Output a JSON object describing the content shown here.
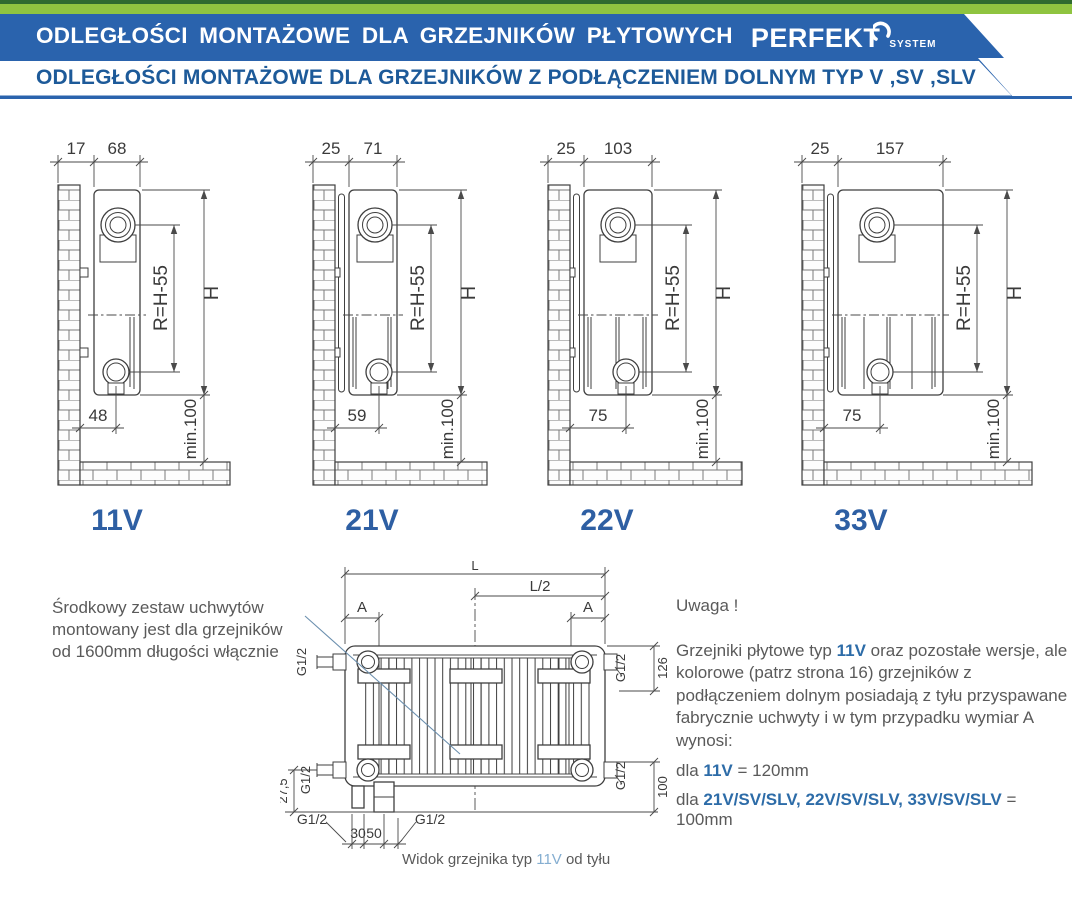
{
  "header": {
    "title": "ODLEGŁOŚCI MONTAŻOWE DLA GRZEJNIKÓW PŁYTOWYCH",
    "brand": "PERFEKT",
    "brand_sub": "SYSTEM",
    "subtitle": "ODLEGŁOŚCI MONTAŻOWE DLA GRZEJNIKÓW Z PODŁĄCZENIEM DOLNYM TYP V ,SV ,SLV"
  },
  "colors": {
    "green_strip": "#8fc440",
    "green_dark": "#2f6b2f",
    "banner_blue": "#2a63ad",
    "subtitle_blue": "#1d5a99",
    "type_label_blue": "#2e5fa3",
    "accent_blue": "#2d6ca8",
    "caption_blue": "#85aed1",
    "text_gray": "#5a5a5a",
    "drawing_line": "#3f3f3f"
  },
  "shared_dims": {
    "r": "R=H-55",
    "h": "H",
    "min": "min.100"
  },
  "diagrams": [
    {
      "label": "11V",
      "wall_offset": "17",
      "depth": "68",
      "pipe_offset": "48"
    },
    {
      "label": "21V",
      "wall_offset": "25",
      "depth": "71",
      "pipe_offset": "59"
    },
    {
      "label": "22V",
      "wall_offset": "25",
      "depth": "103",
      "pipe_offset": "75"
    },
    {
      "label": "33V",
      "wall_offset": "25",
      "depth": "157",
      "pipe_offset": "75"
    }
  ],
  "left_note": {
    "line1": "Środkowy zestaw uchwytów",
    "line2": "montowany jest dla grzejników",
    "line3": "od 1600mm długości włącznie"
  },
  "rear_view": {
    "l": "L",
    "l2": "L/2",
    "a": "A",
    "g12": "G1/2",
    "d126": "126",
    "d100": "100",
    "d275": "27,5",
    "d30": "30",
    "d50": "50",
    "caption_pre": "Widok grzejnika typ ",
    "caption_type": "11V",
    "caption_post": " od tyłu"
  },
  "right_note": {
    "title": "Uwaga !",
    "p_pre": "Grzejniki płytowe typ ",
    "p_type": "11V",
    "p_post": " oraz pozostałe wersje, ale kolorowe (patrz strona 16) grzejników z podłączeniem dolnym posiadają z tyłu przyspawane fabrycznie uchwyty i w tym przypadku wymiar A wynosi:",
    "l1_pre": "dla ",
    "l1_type": "11V",
    "l1_val": " = 120mm",
    "l2_pre": "dla ",
    "l2_types": "21V/SV/SLV, 22V/SV/SLV, 33V/SV/SLV",
    "l2_val": " = 100mm"
  }
}
